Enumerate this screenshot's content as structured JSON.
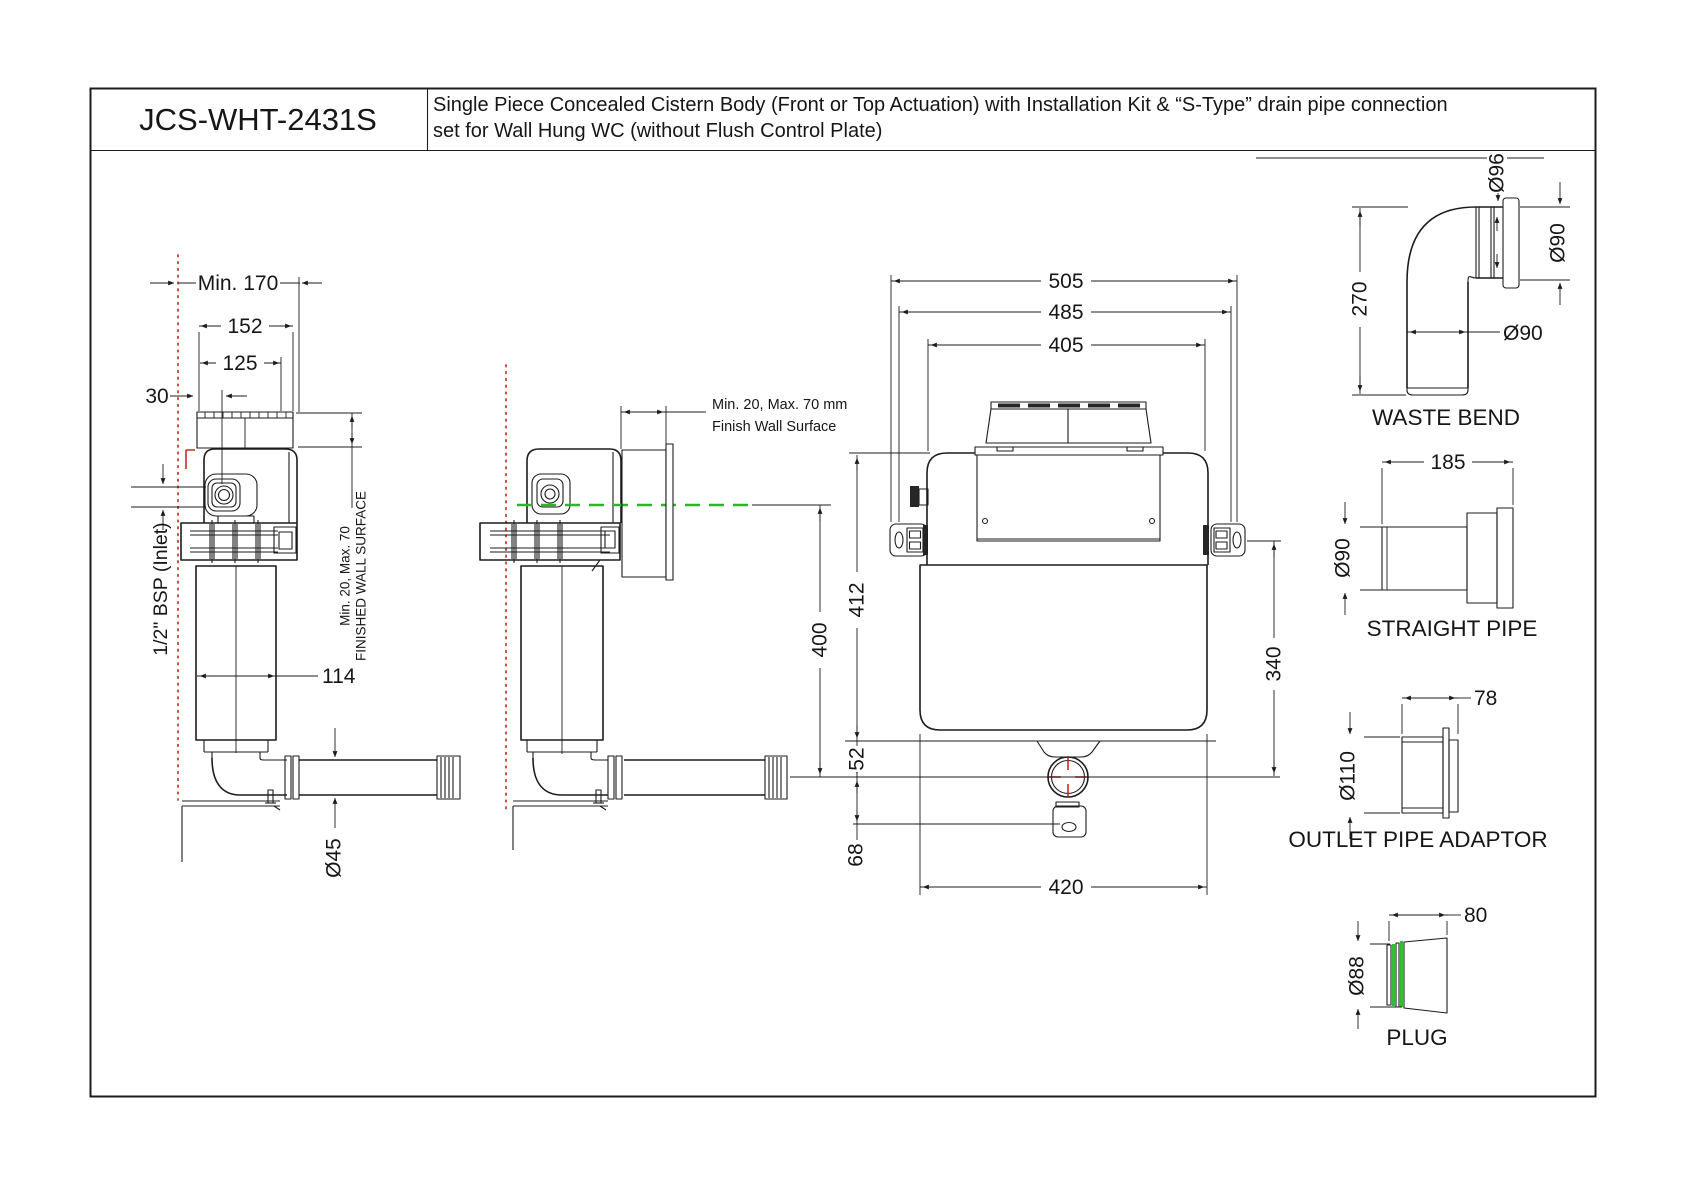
{
  "title_block": {
    "model": "JCS-WHT-2431S",
    "description_line1": "Single Piece Concealed Cistern Body (Front or Top Actuation) with Installation Kit &  “S-Type” drain pipe connection",
    "description_line2": "set for Wall Hung WC (without Flush Control Plate)"
  },
  "side_view": {
    "dim_min_depth": "Min. 170",
    "dim_width": "152",
    "dim_125": "125",
    "dim_30": "30",
    "dim_tank_width": "114",
    "dim_pipe_dia": "Ø45",
    "inlet_label": "1/2\" BSP (Inlet)",
    "wall_note_line1": "Min. 20, Max. 70",
    "wall_note_line2": "FINISHED WALL SURFACE"
  },
  "section_view": {
    "wall_note_line1": "Min. 20, Max. 70 mm",
    "wall_note_line2": "Finish Wall Surface",
    "dim_height": "400"
  },
  "front_view": {
    "dim_overall_width": "505",
    "dim_fixing_width": "485",
    "dim_body_top_width": "405",
    "dim_height": "412",
    "dim_bracket_to_outlet": "340",
    "dim_shelf_to_outlet": "52",
    "dim_outlet_to_slot": "68",
    "dim_body_width": "420"
  },
  "parts": {
    "waste_bend": {
      "label": "WASTE BEND",
      "dim_socket_dia": "Ø96",
      "dim_side_dia": "Ø90",
      "dim_height": "270",
      "dim_pipe_dia": "Ø90"
    },
    "straight_pipe": {
      "label": "STRAIGHT PIPE",
      "dim_length": "185",
      "dim_dia": "Ø90"
    },
    "outlet_pipe_adaptor": {
      "label": "OUTLET PIPE ADAPTOR",
      "dim_length": "78",
      "dim_dia": "Ø110"
    },
    "plug": {
      "label": "PLUG",
      "dim_length": "80",
      "dim_dia": "Ø88"
    }
  },
  "colors": {
    "line": "#1c1c1c",
    "centerline_red": "#c92a21",
    "waterline_green": "#2db52d",
    "crosshair_red": "#c92a21",
    "plug_green": "#35bb35"
  }
}
